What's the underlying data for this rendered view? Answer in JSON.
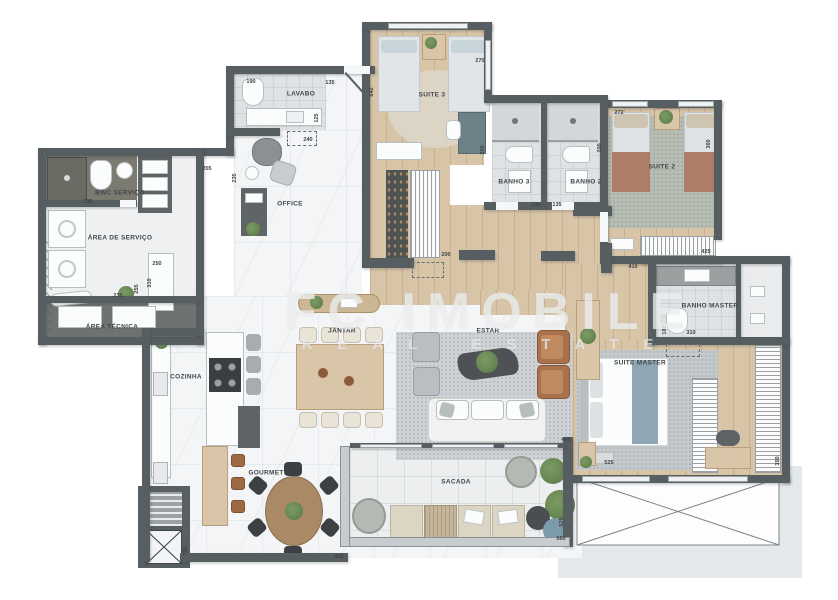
{
  "watermark": {
    "line1": "FC IMOBILE",
    "line2": "REAL ESTATE"
  },
  "colors": {
    "wall": "#575e62",
    "wood_floor": "#d8c5a7",
    "marble_floor": "#f4f5f6",
    "bath_tile": "#dfe2e4",
    "sage_rug": "#b6bdb3",
    "terracotta": "#ad7d68",
    "blue_throw": "#8fa7b5",
    "plant_green": "#6d8b57",
    "backdrop": "#e3e8eb"
  },
  "rooms": [
    {
      "id": "lavabo",
      "label": "LAVABO",
      "x": 301,
      "y": 94
    },
    {
      "id": "office",
      "label": "OFFICE",
      "x": 290,
      "y": 204
    },
    {
      "id": "suite3",
      "label": "SUITE 3",
      "x": 432,
      "y": 95
    },
    {
      "id": "banho3",
      "label": "BANHO 3",
      "x": 514,
      "y": 182
    },
    {
      "id": "banho2",
      "label": "BANHO 2",
      "x": 586,
      "y": 182
    },
    {
      "id": "suite2",
      "label": "SUITE 2",
      "x": 662,
      "y": 167
    },
    {
      "id": "bwc-servico",
      "label": "BWC SERVIÇO",
      "x": 120,
      "y": 193
    },
    {
      "id": "area-servico",
      "label": "ÁREA DE SERVIÇO",
      "x": 120,
      "y": 238
    },
    {
      "id": "area-tecnica",
      "label": "ÁREA TÉCNICA",
      "x": 112,
      "y": 327
    },
    {
      "id": "cozinha",
      "label": "COZINHA",
      "x": 186,
      "y": 377
    },
    {
      "id": "jantar",
      "label": "JANTAR",
      "x": 342,
      "y": 331
    },
    {
      "id": "estar",
      "label": "ESTAR",
      "x": 488,
      "y": 331
    },
    {
      "id": "gourmet",
      "label": "GOURMET",
      "x": 266,
      "y": 473
    },
    {
      "id": "sacada",
      "label": "SACADA",
      "x": 456,
      "y": 482
    },
    {
      "id": "suite-master",
      "label": "SUITE MASTER",
      "x": 640,
      "y": 363
    },
    {
      "id": "banho-master",
      "label": "BANHO MASTER",
      "x": 710,
      "y": 306
    }
  ],
  "dimensions": [
    {
      "v": "190",
      "x": 251,
      "y": 82,
      "rot": false
    },
    {
      "v": "135",
      "x": 330,
      "y": 83,
      "rot": false
    },
    {
      "v": "125",
      "x": 317,
      "y": 118,
      "rot": true
    },
    {
      "v": "240",
      "x": 308,
      "y": 140,
      "rot": false
    },
    {
      "v": "642",
      "x": 372,
      "y": 92,
      "rot": true
    },
    {
      "v": "205",
      "x": 88,
      "y": 202,
      "rot": false
    },
    {
      "v": "205",
      "x": 207,
      "y": 169,
      "rot": false
    },
    {
      "v": "235",
      "x": 235,
      "y": 178,
      "rot": true
    },
    {
      "v": "250",
      "x": 157,
      "y": 264,
      "rot": false
    },
    {
      "v": "310",
      "x": 150,
      "y": 283,
      "rot": true
    },
    {
      "v": "235",
      "x": 118,
      "y": 296,
      "rot": false
    },
    {
      "v": "255",
      "x": 137,
      "y": 289,
      "rot": true
    },
    {
      "v": "270",
      "x": 480,
      "y": 61,
      "rot": false
    },
    {
      "v": "200",
      "x": 483,
      "y": 150,
      "rot": true
    },
    {
      "v": "200",
      "x": 446,
      "y": 255,
      "rot": false
    },
    {
      "v": "130",
      "x": 536,
      "y": 205,
      "rot": false
    },
    {
      "v": "135",
      "x": 557,
      "y": 205,
      "rot": false
    },
    {
      "v": "200",
      "x": 600,
      "y": 148,
      "rot": true
    },
    {
      "v": "272",
      "x": 619,
      "y": 113,
      "rot": false
    },
    {
      "v": "360",
      "x": 709,
      "y": 144,
      "rot": true
    },
    {
      "v": "425",
      "x": 706,
      "y": 252,
      "rot": false
    },
    {
      "v": "410",
      "x": 633,
      "y": 267,
      "rot": false
    },
    {
      "v": "310",
      "x": 691,
      "y": 333,
      "rot": false
    },
    {
      "v": "180",
      "x": 665,
      "y": 330,
      "rot": true
    },
    {
      "v": "525",
      "x": 609,
      "y": 463,
      "rot": false
    },
    {
      "v": "350",
      "x": 778,
      "y": 461,
      "rot": true
    },
    {
      "v": "440",
      "x": 566,
      "y": 440,
      "rot": false
    },
    {
      "v": "560",
      "x": 561,
      "y": 539,
      "rot": false
    },
    {
      "v": "525",
      "x": 562,
      "y": 522,
      "rot": true
    },
    {
      "v": "420",
      "x": 339,
      "y": 557,
      "rot": false
    },
    {
      "v": "790",
      "x": 186,
      "y": 551,
      "rot": true
    }
  ]
}
